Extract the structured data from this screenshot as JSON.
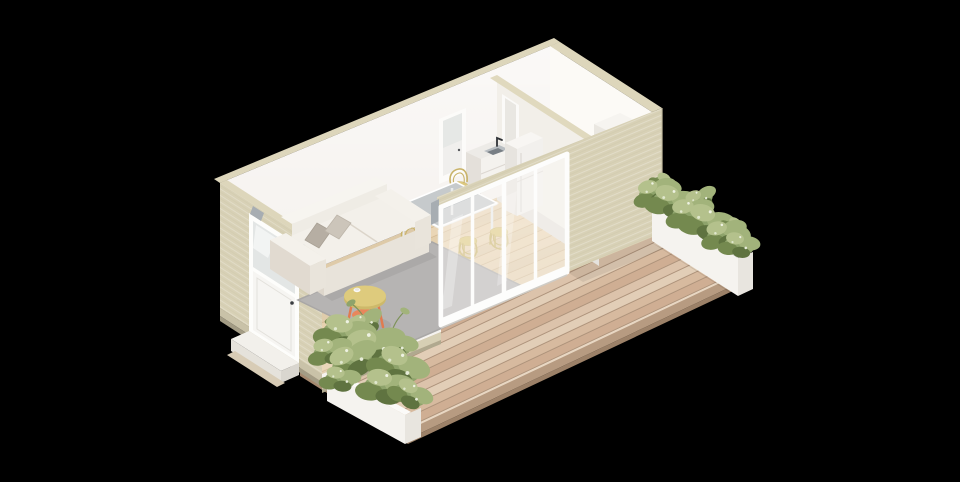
{
  "scene": {
    "type": "isometric-cutaway-architectural-render",
    "description_objects": [
      "studio-apartment-module",
      "wooden-deck",
      "living-area",
      "dining-area",
      "kitchenette",
      "bathroom",
      "sofa",
      "pillows",
      "rug",
      "coffee-table",
      "cup",
      "dining-table",
      "dining-chairs-x5",
      "kitchen-counter",
      "sink",
      "faucet",
      "tall-cabinet",
      "front-door",
      "back-door",
      "partition-door",
      "sliding-glass-door",
      "shower-unit",
      "entry-step",
      "planter-box-left",
      "planter-box-right",
      "plants"
    ]
  },
  "palette": {
    "background": "#000000",
    "deck_wood": "#dcc2aa",
    "floor_wood": "#ead5b2",
    "wall_exterior": "#d8d1b6",
    "wall_interior": "#f7f4f1",
    "wall_top": "#ddd6bb",
    "rug": "#b6b4b3",
    "sofa_fabric": "#f3f0ea",
    "pillow_dark": "#b6aea3",
    "pillow_light": "#ccc5ba",
    "chair_yellow": "#dcc87f",
    "dining_table_top": "#c6cacc",
    "coffee_table_top": "#decb7d",
    "coffee_table_coral": "#e8875c",
    "plant_green": "#8ea36b",
    "plant_dark": "#5f7340",
    "plant_light": "#b4c18c",
    "planter_white": "#f5f3ef",
    "glass": "rgba(253,251,247,0.42)",
    "frame_white": "#fdfdfc",
    "sink_steel": "#787f85",
    "faucet_black": "#2f3236",
    "step_white": "#f2f0eb"
  }
}
